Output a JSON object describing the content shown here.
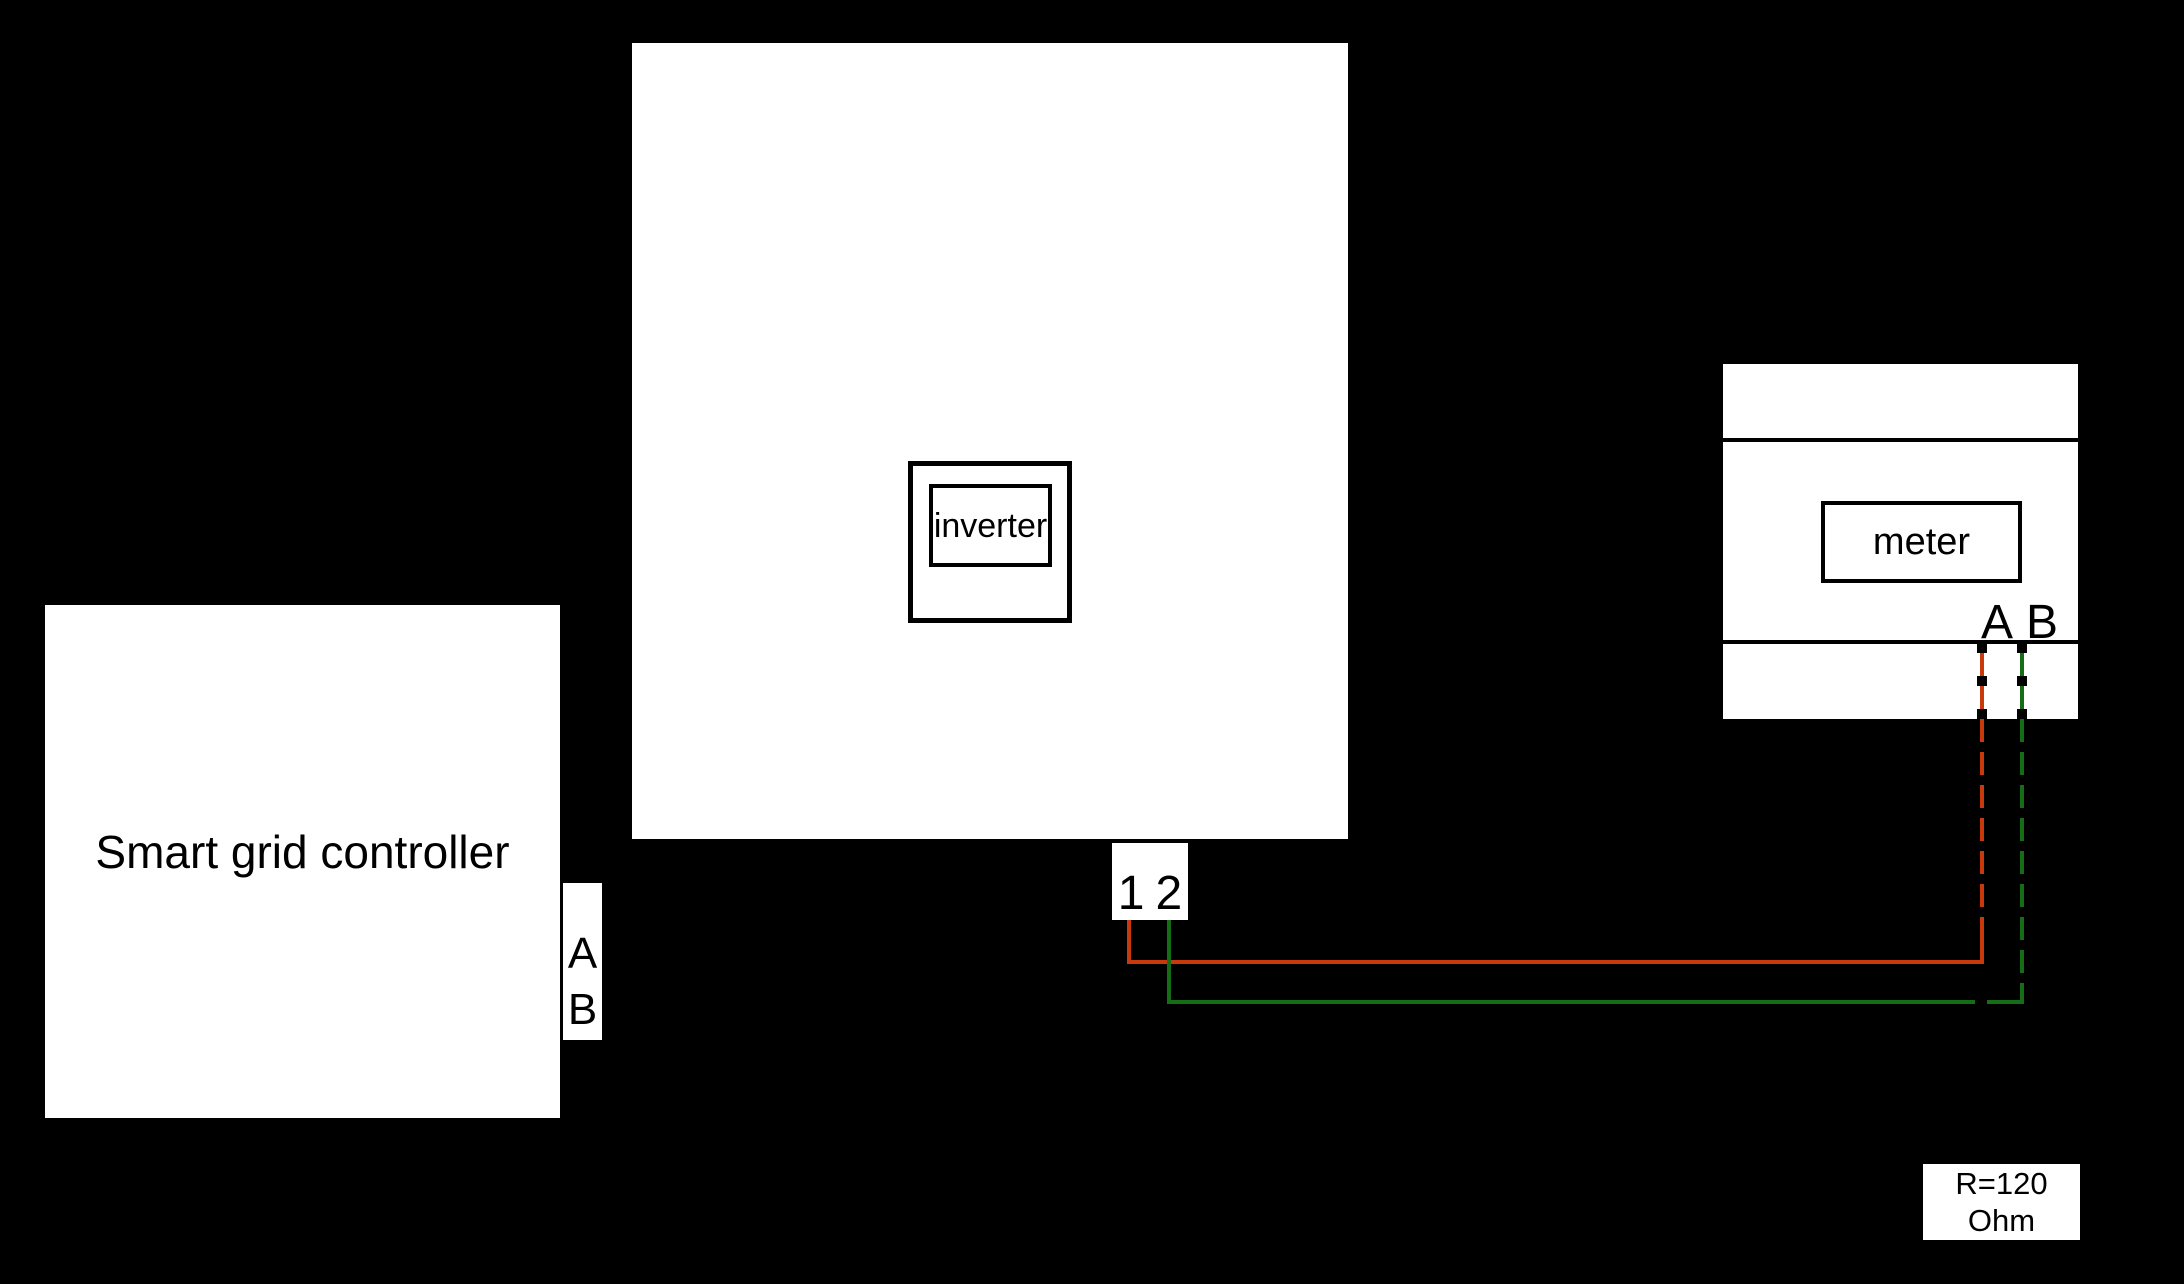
{
  "colors": {
    "background": "#000000",
    "box_fill": "#ffffff",
    "line": "#000000",
    "wire_a": "#c83a0c",
    "wire_b": "#156e15"
  },
  "controller": {
    "label": "Smart grid controller",
    "port_a": "A",
    "port_b": "B"
  },
  "inverter": {
    "label": "inverter"
  },
  "terminals": {
    "t1": "1",
    "t2": "2"
  },
  "meter": {
    "label": "meter",
    "port_a": "A",
    "port_b": "B"
  },
  "resistor": {
    "line1": "R=120",
    "line2": "Ohm"
  }
}
